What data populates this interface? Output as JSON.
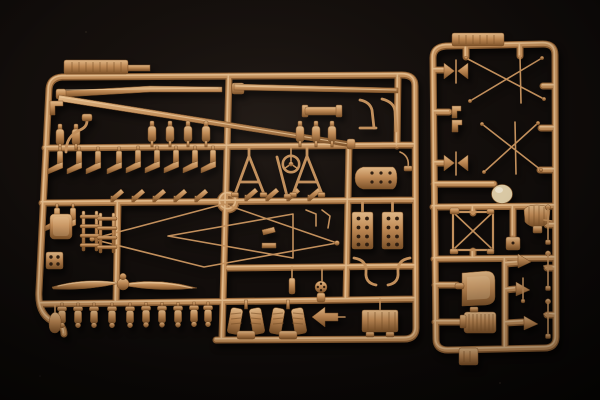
{
  "scene": {
    "description": "Studio photograph of two tan injection-molded plastic model-kit sprues (parts frames) on a black background",
    "colors": {
      "background": "#0d0a08",
      "runner-dark": "#8a5c31",
      "runner-mid": "#c3905c",
      "runner-light": "#ecc99c",
      "plastic-light": "#e2b988",
      "plastic-mid": "#c08a55",
      "plastic-dark": "#7c5128",
      "hole": "#2e1d10",
      "dome": "#d9c8a4"
    },
    "sprues": {
      "left": {
        "name": "large parts sprue",
        "parts": [
          "embossed label tab",
          "long tapered spar rods",
          "upper wing bars",
          "steering wheel",
          "ring gate",
          "cabane A-frame struts",
          "diamond strut assembly",
          "two-blade propeller",
          "valve cylinder row (10)",
          "V engine cylinder banks (2)",
          "ribbed crankcase box",
          "drilled engine blocks (2)",
          "exhaust ladder stacks (2)",
          "cockpit side panel",
          "drilled plate",
          "teardrop counterweight",
          "bottle fittings",
          "boot-shaped brackets",
          "angled flag brackets",
          "curved hooks",
          "rotary knob"
        ]
      },
      "right": {
        "name": "detail parts sprue",
        "parts": [
          "embossed label tab",
          "X rigging frames (2)",
          "bowtie turnbuckles (2)",
          "step brackets",
          "headrest dome",
          "X-braced cabane frame",
          "finned engine block",
          "small junction box",
          "bucket seat",
          "radiator core",
          "control horns (3)",
          "control sticks (3)",
          "bottom mounting tab"
        ]
      }
    }
  }
}
